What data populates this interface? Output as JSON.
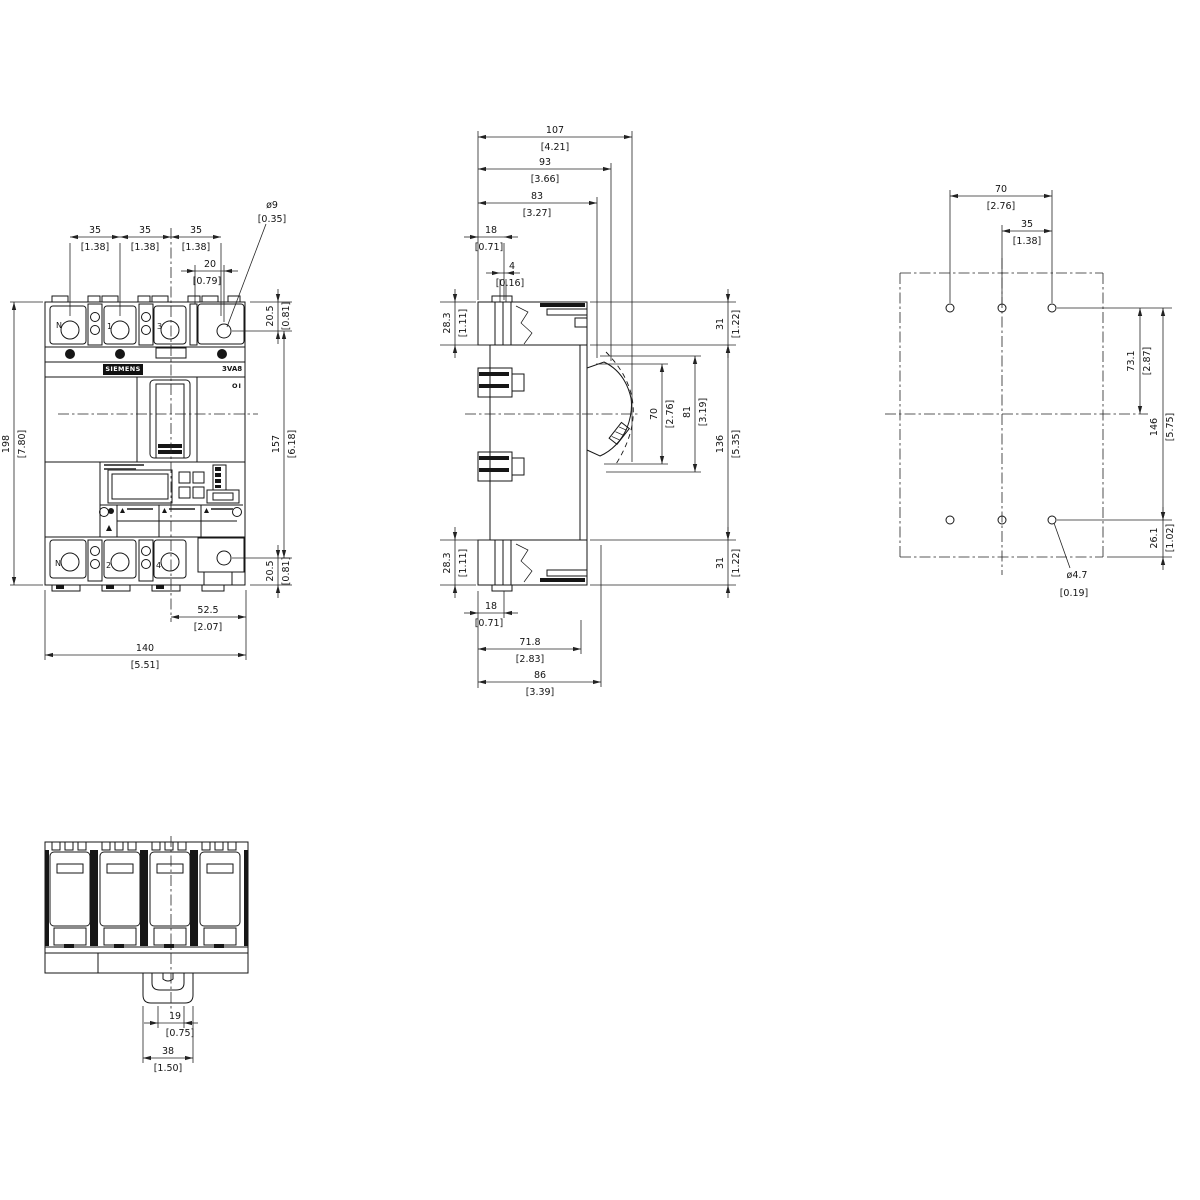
{
  "front": {
    "brand": "SIEMENS",
    "model": "3VA8",
    "switch_marking": "OI",
    "terminals_top": {
      "n": "N",
      "p1": "1",
      "p3": "3"
    },
    "terminals_bottom": {
      "n": "N",
      "p2": "2",
      "p4": "4"
    },
    "dims": {
      "pole_pitch": {
        "mm": "35",
        "in": "[1.38]"
      },
      "hole_dia": {
        "mm": "ø9",
        "in": "[0.35]"
      },
      "hole_offset": {
        "mm": "20",
        "in": "[0.79]"
      },
      "terminal_top": {
        "mm": "20.5",
        "in": "[0.81]"
      },
      "terminal_bottom": {
        "mm": "20.5",
        "in": "[0.81]"
      },
      "height_total": {
        "mm": "198",
        "in": "[7.80]"
      },
      "height_terminals": {
        "mm": "157",
        "in": "[6.18]"
      },
      "center_to_edge": {
        "mm": "52.5",
        "in": "[2.07]"
      },
      "width_total": {
        "mm": "140",
        "in": "[5.51]"
      }
    }
  },
  "side": {
    "dims": {
      "depth_total": {
        "mm": "107",
        "in": "[4.21]"
      },
      "depth_handle": {
        "mm": "93",
        "in": "[3.66]"
      },
      "depth_escutcheon": {
        "mm": "83",
        "in": "[3.27]"
      },
      "rear_offset_top": {
        "mm": "18",
        "in": "[0.71]"
      },
      "rail_lip": {
        "mm": "4",
        "in": "[0.16]"
      },
      "terminal_depth_top": {
        "mm": "28.3",
        "in": "[1.11]"
      },
      "terminal_depth_bottom": {
        "mm": "28.3",
        "in": "[1.11]"
      },
      "cover_top": {
        "mm": "31",
        "in": "[1.22]"
      },
      "cover_bottom": {
        "mm": "31",
        "in": "[1.22]"
      },
      "handle_cutout": {
        "mm": "70",
        "in": "[2.76]"
      },
      "escutcheon_height": {
        "mm": "81",
        "in": "[3.19]"
      },
      "body_height": {
        "mm": "136",
        "in": "[5.35]"
      },
      "rear_offset_bottom": {
        "mm": "18",
        "in": "[0.71]"
      },
      "base_depth": {
        "mm": "71.8",
        "in": "[2.83]"
      },
      "front_depth": {
        "mm": "86",
        "in": "[3.39]"
      }
    }
  },
  "drill": {
    "dims": {
      "hole_span": {
        "mm": "70",
        "in": "[2.76]"
      },
      "hole_half_span": {
        "mm": "35",
        "in": "[1.38]"
      },
      "row_to_center": {
        "mm": "73.1",
        "in": "[2.87]"
      },
      "row_span": {
        "mm": "146",
        "in": "[5.75]"
      },
      "row_to_edge": {
        "mm": "26.1",
        "in": "[1.02]"
      },
      "hole_dia": {
        "mm": "ø4.7",
        "in": "[0.19]"
      }
    }
  },
  "bottom": {
    "dims": {
      "clip_slot": {
        "mm": "19",
        "in": "[0.75]"
      },
      "clip_width": {
        "mm": "38",
        "in": "[1.50]"
      }
    }
  }
}
